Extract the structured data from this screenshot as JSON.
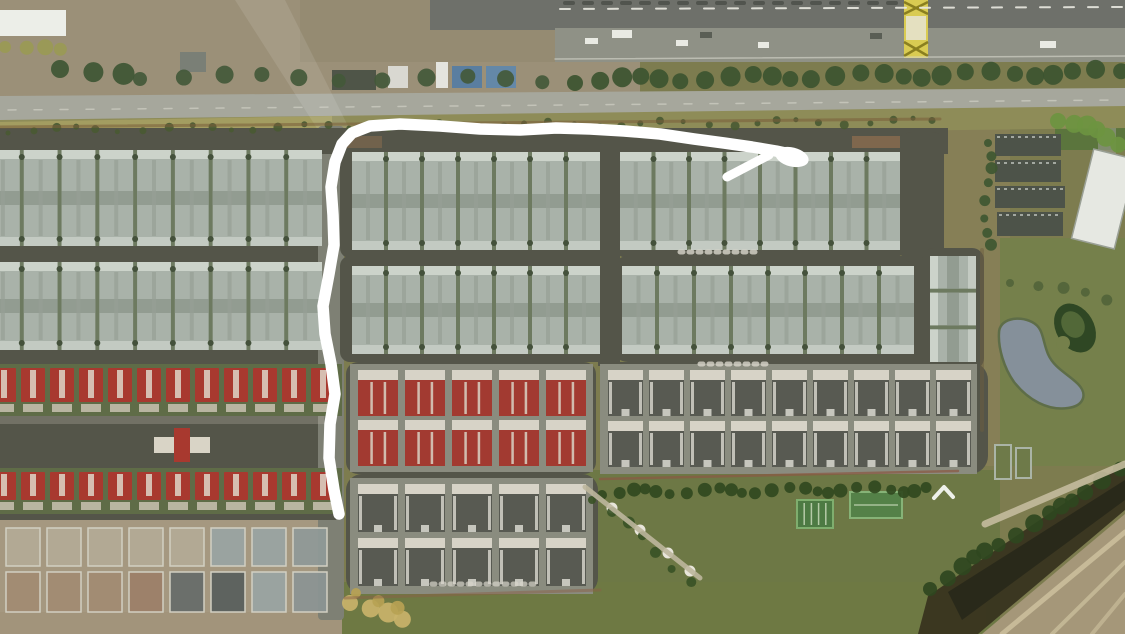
{
  "view": {
    "width": 1125,
    "height": 634,
    "type": "satellite-aerial-photo"
  },
  "palette": {
    "annotation_white": "#ffffff",
    "roof_blue_gray": "#a9b2a9",
    "roof_red": "#a8392f",
    "roof_dark": "#585a52",
    "road_dark": "#545549",
    "road_light": "#a6a79c",
    "grass_base": "#7d7c4f",
    "dirt": "#9b9078",
    "water": "#85909a",
    "tree_dark": "#3c5430",
    "gantry_yellow": "#d9cb52"
  },
  "annotation": {
    "type": "hand-drawn-route",
    "color": "#ffffff",
    "stroke_width": 11.5,
    "points": [
      [
        339,
        514
      ],
      [
        334,
        490
      ],
      [
        329,
        458
      ],
      [
        330,
        424
      ],
      [
        335,
        394
      ],
      [
        331,
        364
      ],
      [
        325,
        334
      ],
      [
        323,
        306
      ],
      [
        329,
        274
      ],
      [
        334,
        245
      ],
      [
        333,
        215
      ],
      [
        331,
        187
      ],
      [
        335,
        162
      ],
      [
        342,
        144
      ],
      [
        352,
        133
      ],
      [
        370,
        126
      ],
      [
        400,
        124
      ],
      [
        440,
        126
      ],
      [
        480,
        129
      ],
      [
        520,
        130
      ],
      [
        556,
        128
      ],
      [
        590,
        129
      ],
      [
        624,
        131
      ],
      [
        660,
        134
      ],
      [
        694,
        139
      ],
      [
        724,
        143
      ],
      [
        752,
        147
      ],
      [
        776,
        151
      ],
      [
        790,
        154
      ]
    ],
    "arrowhead": {
      "cx": 792,
      "cy": 157,
      "rx": 17,
      "ry": 9.5,
      "rotate": 14
    },
    "barb": {
      "x1": 727,
      "y1": 177,
      "x2": 769,
      "y2": 155,
      "width": 9
    }
  },
  "scene": {
    "base": [
      {
        "x": 0,
        "y": 0,
        "w": 1125,
        "h": 634,
        "f": "#7d7c4f"
      },
      {
        "x": 0,
        "y": 0,
        "w": 640,
        "h": 98,
        "f": "#9b9078"
      },
      {
        "x": 300,
        "y": 0,
        "w": 340,
        "h": 62,
        "f": "#958b72"
      },
      {
        "x": 430,
        "y": 0,
        "w": 695,
        "h": 30,
        "f": "#6e706a"
      },
      {
        "x": 555,
        "y": 28,
        "w": 570,
        "h": 34,
        "f": "#8f9186"
      },
      {
        "x": 940,
        "y": 126,
        "w": 70,
        "h": 340,
        "f": "#867f56"
      },
      {
        "x": 1000,
        "y": 238,
        "w": 125,
        "h": 228,
        "f": "#75804b"
      },
      {
        "x": 580,
        "y": 470,
        "w": 420,
        "h": 164,
        "f": "#6d7845"
      },
      {
        "x": 336,
        "y": 582,
        "w": 650,
        "h": 52,
        "f": "#6e7943"
      },
      {
        "x": 0,
        "y": 516,
        "w": 336,
        "h": 118,
        "f": "#a59880"
      },
      {
        "x": 0,
        "y": 612,
        "w": 342,
        "h": 22,
        "f": "#a2947b"
      },
      {
        "x": 1055,
        "y": 108,
        "w": 70,
        "h": 42,
        "f": "#55743a",
        "o": 0.85
      },
      {
        "x": 1098,
        "y": 94,
        "w": 18,
        "h": 120,
        "f": "#9a9b8f",
        "o": 0.6,
        "rx": 6
      },
      {
        "x": 0,
        "y": 10,
        "w": 66,
        "h": 26,
        "f": "#eceee8"
      },
      {
        "x": 180,
        "y": 52,
        "w": 26,
        "h": 20,
        "f": "#7a7f76"
      },
      {
        "x": 332,
        "y": 70,
        "w": 44,
        "h": 20,
        "f": "#4f5548"
      },
      {
        "x": 388,
        "y": 66,
        "w": 20,
        "h": 22,
        "f": "#d9d8d1"
      },
      {
        "x": 436,
        "y": 62,
        "w": 12,
        "h": 26,
        "f": "#e4e4de"
      },
      {
        "x": 452,
        "y": 66,
        "w": 30,
        "h": 22,
        "f": "#5a7ea0"
      },
      {
        "x": 486,
        "y": 66,
        "w": 30,
        "h": 22,
        "f": "#6488a8"
      }
    ],
    "polys": [
      {
        "pts": "0,96 1125,88 1125,112 0,122",
        "f": "#a6a79c"
      },
      {
        "pts": "0,120 1125,106 1125,128 0,142",
        "f": "#8e8c58"
      },
      {
        "pts": "0,122 332,116 332,140 0,144",
        "f": "#a59f63",
        "o": 0.9
      },
      {
        "pts": "928,596 1125,462 1125,510 978,634 918,634",
        "f": "#38341f",
        "o": 0.95
      },
      {
        "pts": "982,634 1125,514 1125,634",
        "f": "#a59779"
      },
      {
        "pts": "948,592 1125,480 1125,500 962,620",
        "f": "#262619",
        "o": 0.8
      },
      {
        "pts": "235,0 285,0 350,130 318,130",
        "f": "#ffffff",
        "o": 0.1
      }
    ],
    "pads": [
      {
        "x": -20,
        "y": 132,
        "w": 344,
        "h": 124,
        "rx": 10
      },
      {
        "x": -20,
        "y": 254,
        "w": 344,
        "h": 106,
        "rx": 10
      },
      {
        "x": -20,
        "y": 358,
        "w": 344,
        "h": 70,
        "rx": 10
      },
      {
        "x": -20,
        "y": 426,
        "w": 344,
        "h": 44,
        "rx": 6
      },
      {
        "x": -20,
        "y": 468,
        "w": 344,
        "h": 50,
        "rx": 10
      },
      {
        "x": 318,
        "y": 126,
        "w": 26,
        "h": 494,
        "rx": 4,
        "f": "#7e8074"
      },
      {
        "x": 0,
        "y": 128,
        "w": 948,
        "h": 26,
        "rx": 0
      },
      {
        "x": 340,
        "y": 132,
        "w": 268,
        "h": 126,
        "rx": 10
      },
      {
        "x": 340,
        "y": 256,
        "w": 268,
        "h": 106,
        "rx": 10
      },
      {
        "x": 612,
        "y": 132,
        "w": 296,
        "h": 126,
        "rx": 16
      },
      {
        "x": 612,
        "y": 256,
        "w": 344,
        "h": 106,
        "rx": 16
      },
      {
        "x": 598,
        "y": 130,
        "w": 22,
        "h": 236,
        "rx": 0
      },
      {
        "x": 900,
        "y": 132,
        "w": 44,
        "h": 130,
        "rx": 12
      },
      {
        "x": 346,
        "y": 362,
        "w": 250,
        "h": 112,
        "rx": 12
      },
      {
        "x": 346,
        "y": 474,
        "w": 252,
        "h": 120,
        "rx": 16
      },
      {
        "x": 600,
        "y": 362,
        "w": 388,
        "h": 112,
        "rx": 18
      },
      {
        "x": 922,
        "y": 248,
        "w": 62,
        "h": 122,
        "rx": 12
      },
      {
        "x": 0,
        "y": 512,
        "w": 336,
        "h": 8,
        "rx": 0
      }
    ],
    "tints": [
      {
        "x": 852,
        "y": 136,
        "w": 48,
        "h": 12,
        "f": "#a97a52",
        "o": 0.5
      },
      {
        "x": 346,
        "y": 136,
        "w": 36,
        "h": 12,
        "f": "#a97a52",
        "o": 0.35
      },
      {
        "x": -20,
        "y": 410,
        "w": 344,
        "h": 14,
        "f": "#b8b4a4",
        "o": 0.3
      }
    ],
    "blueRows": [
      {
        "x": -14,
        "y": 150,
        "w": 336,
        "h": 96,
        "n": 9
      },
      {
        "x": -14,
        "y": 262,
        "w": 336,
        "h": 88,
        "n": 9
      },
      {
        "x": 352,
        "y": 152,
        "w": 248,
        "h": 98,
        "n": 7
      },
      {
        "x": 620,
        "y": 152,
        "w": 280,
        "h": 98,
        "n": 8
      },
      {
        "x": 352,
        "y": 266,
        "w": 248,
        "h": 88,
        "n": 7
      },
      {
        "x": 622,
        "y": 266,
        "w": 292,
        "h": 88,
        "n": 8
      }
    ],
    "blueCols": [
      {
        "x": 930,
        "y": 256,
        "w": 46,
        "h": 106,
        "n": 3
      }
    ],
    "redRows": [
      {
        "x": -8,
        "y": 368,
        "count": 12,
        "step": 29,
        "hw": 24,
        "hh": 34
      },
      {
        "x": -8,
        "y": 472,
        "count": 12,
        "step": 29,
        "hw": 24,
        "hh": 28
      }
    ],
    "redCross": [
      {
        "x": 154,
        "y": 437,
        "w": 56,
        "h": 16,
        "f": "#d9d4c6"
      },
      {
        "x": 174,
        "y": 428,
        "w": 16,
        "h": 34,
        "f": "#a8392f"
      }
    ],
    "clusters": [
      {
        "x": 358,
        "y": 370,
        "cols": 5,
        "rows": 2,
        "step": 47,
        "cw": 40,
        "ch": 46,
        "gap": 4,
        "type": "red"
      },
      {
        "x": 358,
        "y": 484,
        "cols": 5,
        "rows": 2,
        "step": 47,
        "cw": 40,
        "ch": 48,
        "gap": 6,
        "type": "dark"
      },
      {
        "x": 608,
        "y": 370,
        "cols": 9,
        "rows": 2,
        "step": 41,
        "cw": 35,
        "ch": 46,
        "gap": 5,
        "type": "dark"
      }
    ],
    "construction": {
      "x": 6,
      "step": 41,
      "cw": 34,
      "cols": 8,
      "rows": [
        {
          "y": 528,
          "h": 38
        },
        {
          "y": 572,
          "h": 40
        }
      ],
      "default_fill": "#c3bfae",
      "default_opacity": 0.45,
      "stroke": "#d2cfc2",
      "ovr": [
        [
          0,
          5,
          "#99a3a1"
        ],
        [
          0,
          6,
          "#99a3a1"
        ],
        [
          0,
          7,
          "#8f9997"
        ],
        [
          1,
          0,
          "#a18b72"
        ],
        [
          1,
          1,
          "#a18b72"
        ],
        [
          1,
          2,
          "#a18b72"
        ],
        [
          1,
          3,
          "#9c8068"
        ],
        [
          1,
          4,
          "#676d69"
        ],
        [
          1,
          5,
          "#5a605d"
        ],
        [
          1,
          6,
          "#99a3a1"
        ],
        [
          1,
          7,
          "#8b9492"
        ]
      ]
    },
    "gantry": {
      "x": 904,
      "y": 0,
      "w": 24,
      "h": 58,
      "f": "#d9cb52",
      "truss": "#8a7f1f",
      "mid": "#e4e0c0"
    },
    "pond": {
      "d": "M 999 333 C 999 319 1018 315 1032 322 C 1044 328 1042 340 1048 354 C 1054 368 1068 374 1078 384 C 1088 394 1084 406 1068 408 C 1048 411 1028 400 1014 382 C 1004 368 998 348 999 333 Z",
      "f": "#85909a",
      "s": "#5e6d48",
      "sw": 2.5
    },
    "mound": {
      "cx": 1075,
      "cy": 328,
      "rx": 19,
      "ry": 26,
      "rot": -30,
      "f": "#2f4724",
      "inner_f": "#526838",
      "notch": {
        "cx": 1063,
        "cy": 343,
        "r": 7,
        "f": "#75804b"
      }
    },
    "courts": [
      {
        "x": 797,
        "y": 500,
        "w": 36,
        "h": 28,
        "f": "#4d7a43",
        "s": "#7fae6e",
        "stripes": "v"
      },
      {
        "x": 850,
        "y": 492,
        "w": 52,
        "h": 26,
        "f": "#548148",
        "s": "#86b377",
        "stripes": "h"
      }
    ],
    "fences": [
      {
        "x": 995,
        "y": 445,
        "w": 16,
        "h": 34
      },
      {
        "x": 1016,
        "y": 448,
        "w": 15,
        "h": 30
      }
    ],
    "slabs": [
      {
        "x": 995,
        "y": 134,
        "w": 66,
        "h": 22
      },
      {
        "x": 995,
        "y": 160,
        "w": 66,
        "h": 22
      },
      {
        "x": 995,
        "y": 186,
        "w": 70,
        "h": 22
      },
      {
        "x": 997,
        "y": 212,
        "w": 66,
        "h": 24
      }
    ],
    "warehouse": {
      "x": 1082,
      "y": 153,
      "w": 44,
      "h": 92,
      "rot": 14,
      "f": "#e6e8e2",
      "s": "#9aa096"
    },
    "cars_light": [
      [
        585,
        38,
        13,
        6
      ],
      [
        612,
        30,
        20,
        8
      ],
      [
        676,
        40,
        12,
        6
      ],
      [
        758,
        42,
        11,
        6
      ],
      [
        1040,
        41,
        16,
        7
      ]
    ],
    "cars_dark": [
      [
        700,
        32,
        12,
        6
      ],
      [
        870,
        33,
        12,
        6
      ]
    ],
    "white_blobs": [
      [
        612,
        508
      ],
      [
        640,
        530
      ],
      [
        668,
        553
      ],
      [
        690,
        571
      ]
    ],
    "chevron": [
      [
        934,
        498
      ],
      [
        944,
        487
      ],
      [
        953,
        497
      ]
    ],
    "tree_lines": [
      {
        "x1": 575,
        "y1": 80,
        "x2": 1120,
        "y2": 72,
        "n": 26,
        "r": 9,
        "f": "#3c5430"
      },
      {
        "x1": 140,
        "y1": 76,
        "x2": 545,
        "y2": 80,
        "n": 11,
        "r": 8,
        "f": "#43593a"
      },
      {
        "x1": 8,
        "y1": 130,
        "x2": 935,
        "y2": 121,
        "n": 42,
        "r": 3.5,
        "f": "#4a5a33"
      },
      {
        "x1": 988,
        "y1": 140,
        "x2": 988,
        "y2": 246,
        "n": 8,
        "r": 5,
        "f": "#3f5731"
      },
      {
        "x1": 602,
        "y1": 492,
        "x2": 930,
        "y2": 489,
        "n": 24,
        "r": 6,
        "f": "#31491f"
      },
      {
        "x1": 930,
        "y1": 586,
        "x2": 1118,
        "y2": 472,
        "n": 14,
        "r": 8,
        "f": "#2f4720"
      },
      {
        "x1": 1058,
        "y1": 118,
        "x2": 1122,
        "y2": 142,
        "n": 6,
        "r": 9,
        "f": "#6d9440"
      },
      {
        "x1": 592,
        "y1": 497,
        "x2": 692,
        "y2": 580,
        "n": 7,
        "r": 5,
        "f": "#3a5226"
      },
      {
        "x1": 60,
        "y1": 66,
        "x2": 120,
        "y2": 76,
        "n": 3,
        "r": 10,
        "f": "#3e5634"
      },
      {
        "x1": 5,
        "y1": 44,
        "x2": 60,
        "y2": 52,
        "n": 4,
        "r": 7,
        "f": "#9a9a55"
      },
      {
        "x1": 350,
        "y1": 600,
        "x2": 402,
        "y2": 622,
        "n": 4,
        "r": 9,
        "f": "#c9b36a"
      },
      {
        "x1": 356,
        "y1": 590,
        "x2": 394,
        "y2": 610,
        "n": 3,
        "r": 6,
        "f": "#b7a254"
      },
      {
        "x1": 1010,
        "y1": 280,
        "x2": 1110,
        "y2": 300,
        "n": 5,
        "r": 5,
        "f": "#52643a"
      }
    ],
    "lines": [
      {
        "x1": 560,
        "y1": 9,
        "x2": 1125,
        "y2": 7,
        "s": "#e9e9e1",
        "w": 2,
        "dash": "10 14",
        "o": 0.9
      },
      {
        "x1": 565,
        "y1": 3,
        "x2": 900,
        "y2": 3,
        "s": "#3a3e36",
        "w": 4,
        "dash": "8 11",
        "o": 0.55
      },
      {
        "x1": 555,
        "y1": 59,
        "x2": 1125,
        "y2": 56,
        "s": "#d8d8cf",
        "w": 1.5,
        "o": 0.6
      },
      {
        "x1": 8,
        "y1": 110,
        "x2": 1120,
        "y2": 100,
        "s": "#d2d2c7",
        "w": 1.5,
        "dash": "8 18",
        "o": 0.65
      },
      {
        "x1": 0,
        "y1": 127,
        "x2": 940,
        "y2": 119,
        "s": "#7a5c3a",
        "w": 3,
        "o": 0.55
      },
      {
        "x1": 600,
        "y1": 479,
        "x2": 958,
        "y2": 471,
        "s": "#8a5a44",
        "w": 2.5,
        "o": 0.75
      },
      {
        "x1": 345,
        "y1": 598,
        "x2": 600,
        "y2": 590,
        "s": "#8a5f48",
        "w": 3,
        "o": 0.5
      },
      {
        "x1": 680,
        "y1": 252,
        "x2": 756,
        "y2": 252,
        "s": "#d8d6cc",
        "w": 5,
        "dash": "3 6",
        "o": 0.8
      },
      {
        "x1": 700,
        "y1": 364,
        "x2": 772,
        "y2": 364,
        "s": "#d8d6cc",
        "w": 5,
        "dash": "3 6",
        "o": 0.8
      },
      {
        "x1": 432,
        "y1": 584,
        "x2": 540,
        "y2": 584,
        "s": "#d8d6cc",
        "w": 5,
        "dash": "3 6",
        "o": 0.7
      },
      {
        "x1": 585,
        "y1": 487,
        "x2": 700,
        "y2": 578,
        "s": "#bdb69c",
        "w": 5,
        "o": 0.9
      },
      {
        "x1": 985,
        "y1": 524,
        "x2": 1125,
        "y2": 464,
        "s": "#c4bb9d",
        "w": 7,
        "o": 0.9
      },
      {
        "x1": 1002,
        "y1": 634,
        "x2": 1125,
        "y2": 532,
        "s": "#cfc3a0",
        "w": 5,
        "o": 0.8
      },
      {
        "x1": 1052,
        "y1": 634,
        "x2": 1125,
        "y2": 562,
        "s": "#cfc3a0",
        "w": 4,
        "o": 0.7
      },
      {
        "x1": 1092,
        "y1": 634,
        "x2": 1125,
        "y2": 594,
        "s": "#cfc3a0",
        "w": 4,
        "o": 0.6
      },
      {
        "x1": 982,
        "y1": 250,
        "x2": 982,
        "y2": 430,
        "s": "#6b5d3f",
        "w": 4,
        "o": 0.5
      }
    ]
  }
}
